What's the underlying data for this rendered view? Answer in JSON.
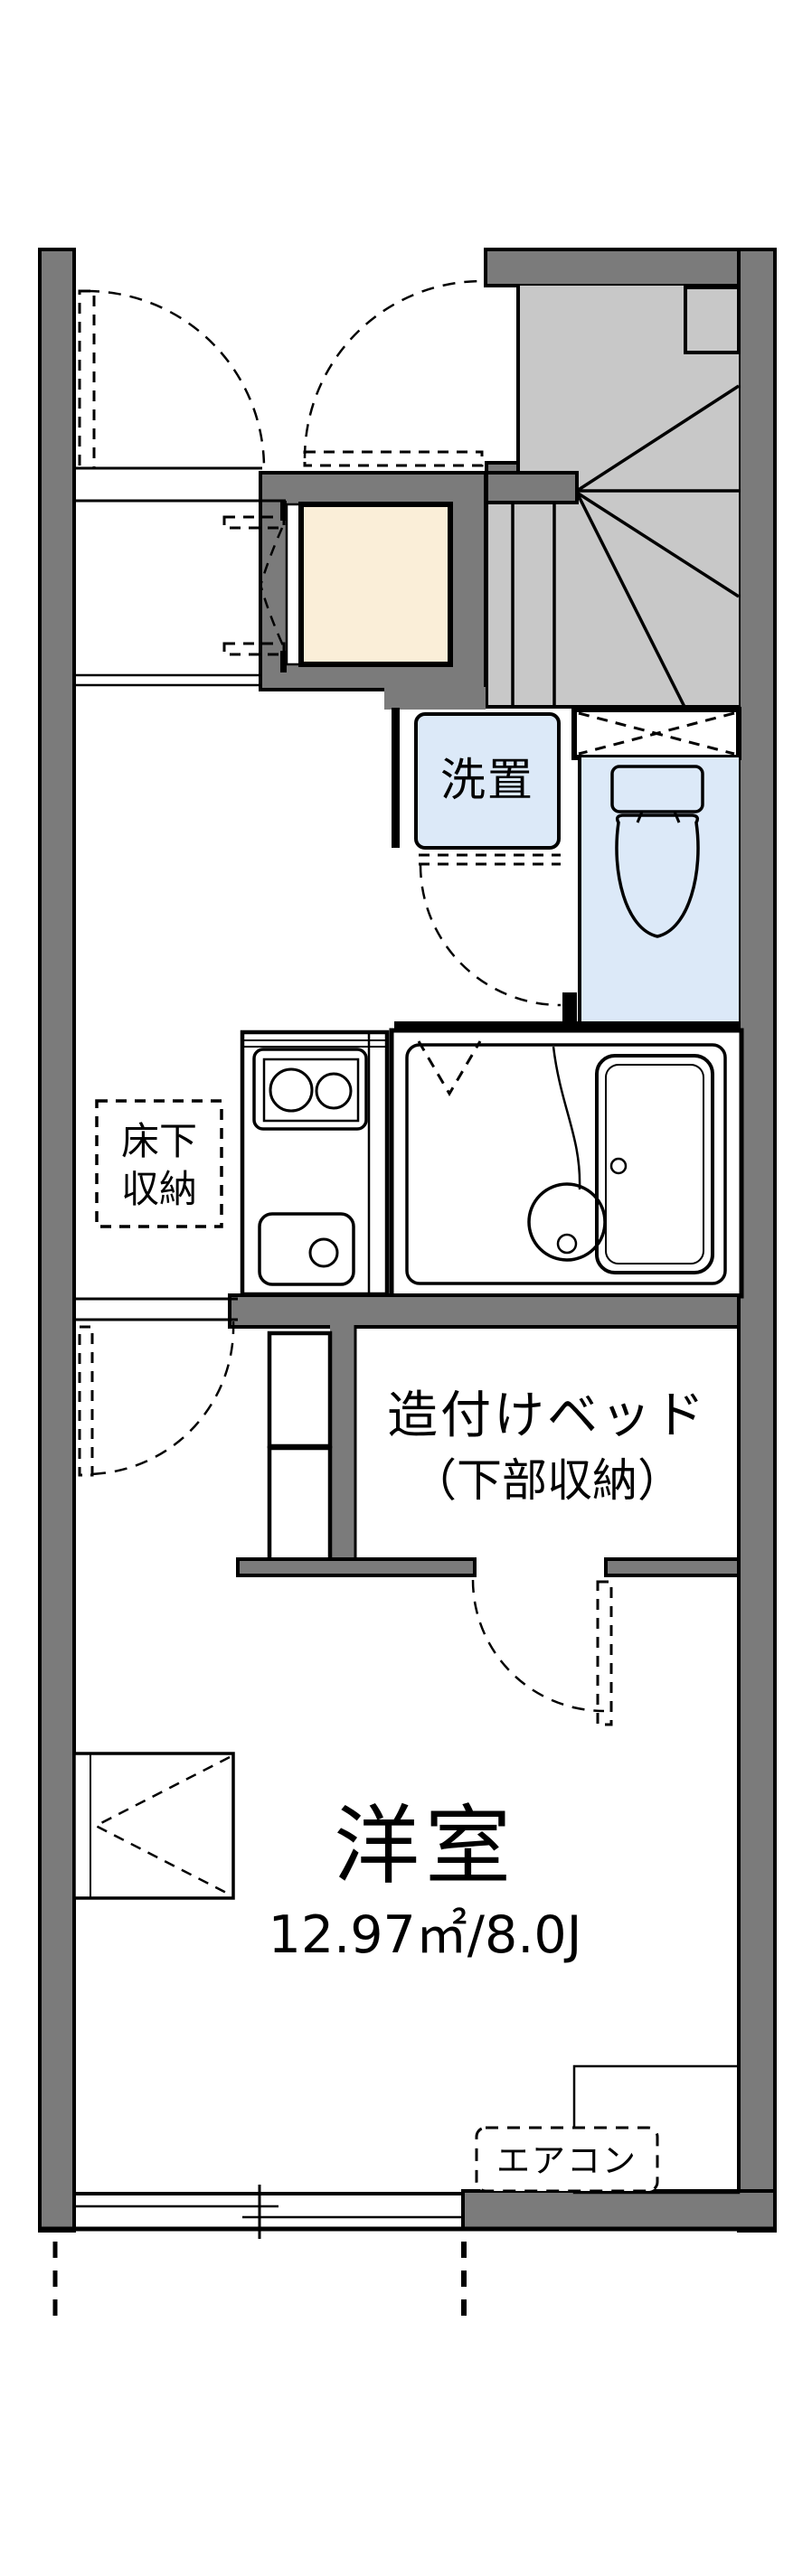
{
  "plan": {
    "type": "apartment-floorplan",
    "rooms": {
      "washer_space": {
        "label": "洗置"
      },
      "underfloor_storage": {
        "label": "床下収納",
        "label_lines": [
          "床下",
          "収納"
        ]
      },
      "built_in_bed": {
        "label_lines": [
          "造付けベッド",
          "（下部収納）"
        ]
      },
      "western_room": {
        "label": "洋室",
        "area_text": "12.97㎡/8.0J"
      },
      "air_conditioner": {
        "label": "エアコン"
      }
    },
    "colors": {
      "wall_gray": "#7b7b7b",
      "stair_gray": "#c8c8c8",
      "fixture_blue": "#dce9f8",
      "accent_cream": "#faeed8",
      "line_black": "#000000",
      "background": "#ffffff"
    }
  }
}
